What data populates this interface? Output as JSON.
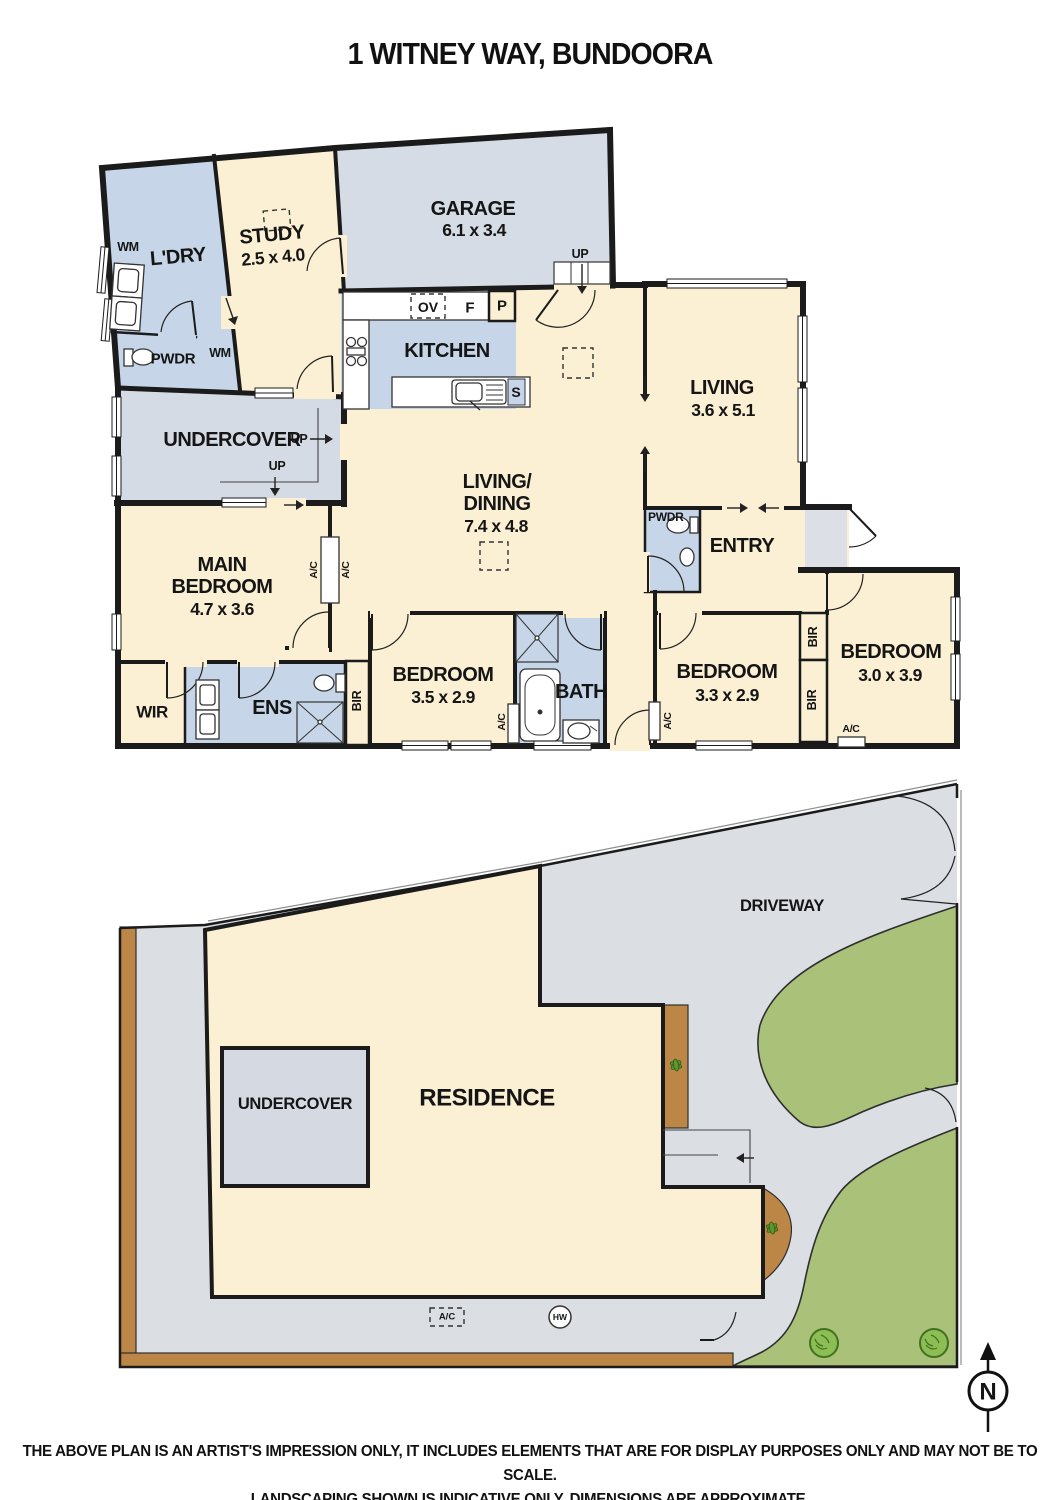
{
  "title": "1 WITNEY WAY, BUNDOORA",
  "colors": {
    "cream": "#FBF0D3",
    "wet_blue": "#C6D6E8",
    "garage_grey": "#D6DCE5",
    "porch_grey": "#DCE0E6",
    "paving_grey": "#DBDEE3",
    "lawn_green": "#A9C178",
    "bush_green": "#8DBE55",
    "garden_brown": "#BC8746",
    "wall": "#1B1B1B"
  },
  "floorplan": {
    "rooms": {
      "garage": {
        "name": "GARAGE",
        "dims": "6.1 x 3.4"
      },
      "study": {
        "name": "STUDY",
        "dims": "2.5 x 4.0"
      },
      "laundry": {
        "name": "L'DRY"
      },
      "powder1": {
        "name": "PWDR"
      },
      "kitchen": {
        "name": "KITCHEN"
      },
      "living": {
        "name": "LIVING",
        "dims": "3.6 x 5.1"
      },
      "living_dining": {
        "line1": "LIVING/",
        "line2": "DINING",
        "dims": "7.4 x 4.8"
      },
      "undercover": {
        "name": "UNDERCOVER"
      },
      "main_bedroom": {
        "line1": "MAIN",
        "line2": "BEDROOM",
        "dims": "4.7 x 3.6"
      },
      "wir": {
        "name": "WIR"
      },
      "ens": {
        "name": "ENS"
      },
      "bedroom2": {
        "name": "BEDROOM",
        "dims": "3.5 x 2.9"
      },
      "bath": {
        "name": "BATH"
      },
      "bedroom3": {
        "name": "BEDROOM",
        "dims": "3.3 x 2.9"
      },
      "bedroom4": {
        "name": "BEDROOM",
        "dims": "3.0 x 3.9"
      },
      "entry": {
        "name": "ENTRY"
      },
      "powder2": {
        "name": "PWDR"
      }
    },
    "markers": {
      "wm": "WM",
      "up": "UP",
      "bir": "BIR",
      "ac": "A/C",
      "ov": "OV",
      "f": "F",
      "p": "P",
      "s": "S"
    }
  },
  "siteplan": {
    "driveway": "DRIVEWAY",
    "residence": "RESIDENCE",
    "undercover": "UNDERCOVER",
    "ac": "A/C",
    "hw": "HW",
    "compass_n": "N"
  },
  "footer": {
    "line1": "THE ABOVE PLAN IS AN ARTIST'S IMPRESSION ONLY, IT INCLUDES ELEMENTS THAT ARE FOR DISPLAY PURPOSES ONLY AND MAY NOT BE TO SCALE.",
    "line2": "LANDSCAPING SHOWN IS INDICATIVE ONLY. DIMENSIONS ARE APPROXIMATE."
  }
}
